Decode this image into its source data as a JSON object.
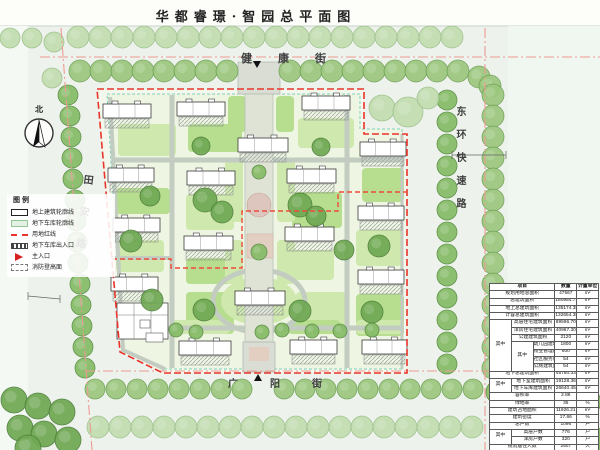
{
  "title": "华都睿璟·智园总平面图",
  "north_label": "北",
  "streets": {
    "top": "健康街",
    "bottom": "广阳街",
    "left": "田安路",
    "right": "东环快速路"
  },
  "legend": {
    "title": "图例",
    "items": [
      {
        "key": "building-outline",
        "label": "地上建筑轮廓线"
      },
      {
        "key": "garage-outline",
        "label": "地下车库轮廓线"
      },
      {
        "key": "red-line",
        "label": "用地红线"
      },
      {
        "key": "garage-entrance",
        "label": "地下车库出入口"
      },
      {
        "key": "main-entrance",
        "label": "主入口"
      },
      {
        "key": "fire-surface",
        "label": "消防登高面"
      }
    ]
  },
  "colors": {
    "boundary_red": "#e8342a",
    "road_centerline": "#ee9a94",
    "garage_line": "#7fd0bd",
    "tree_green": "#85bb66",
    "lawn_green": "#b7dd8e"
  },
  "table": {
    "header": [
      {
        "t": "项目",
        "cs": 3
      },
      {
        "t": "数量"
      },
      {
        "t": "计量单位"
      }
    ],
    "rows": [
      [
        {
          "t": "规划用地总面积",
          "cs": 3
        },
        {
          "t": "47567"
        },
        {
          "t": "m²"
        }
      ],
      [
        {
          "t": "总建筑面积",
          "cs": 3
        },
        {
          "t": "180954.71"
        },
        {
          "t": "m²"
        }
      ],
      [
        {
          "t": "地上总建筑面积",
          "cs": 3
        },
        {
          "t": "135174.38"
        },
        {
          "t": "m²"
        }
      ],
      [
        {
          "t": "计容总建筑面积",
          "cs": 3
        },
        {
          "t": "132654.38"
        },
        {
          "t": "m²"
        }
      ],
      [
        {
          "t": "其中",
          "rs": 7
        },
        {
          "t": "高层住宅建筑面积",
          "cs": 2
        },
        {
          "t": "89596.70"
        },
        {
          "t": "m²"
        }
      ],
      [
        {
          "t": "洋房住宅建筑面积",
          "cs": 2
        },
        {
          "t": "40967.30"
        },
        {
          "t": "m²"
        }
      ],
      [
        {
          "t": "公建建筑面积",
          "cs": 2
        },
        {
          "t": "2120"
        },
        {
          "t": "m²"
        }
      ],
      [
        {
          "t": "其中",
          "rs": 4
        },
        {
          "t": "幼儿园建筑面积"
        },
        {
          "t": "1800"
        },
        {
          "t": "m²"
        }
      ],
      [
        {
          "t": "物业管理用房面积"
        },
        {
          "t": "600"
        },
        {
          "t": "m²"
        }
      ],
      [
        {
          "t": "社区服务用房面积"
        },
        {
          "t": "54"
        },
        {
          "t": "m²"
        }
      ],
      [
        {
          "t": "公厕建筑面积"
        },
        {
          "t": "54"
        },
        {
          "t": "m²"
        }
      ],
      [
        {
          "t": "地下总建筑面积",
          "cs": 3
        },
        {
          "t": "45780.33"
        },
        {
          "t": "m²"
        }
      ],
      [
        {
          "t": "其中",
          "rs": 2
        },
        {
          "t": "地下室建筑面积",
          "cs": 2
        },
        {
          "t": "19128.36"
        },
        {
          "t": "m²"
        }
      ],
      [
        {
          "t": "地下车库建筑面积",
          "cs": 2
        },
        {
          "t": "26640.45"
        },
        {
          "t": "m²"
        }
      ],
      [
        {
          "t": "容积率",
          "cs": 3
        },
        {
          "t": "2.86"
        },
        {
          "t": ""
        }
      ],
      [
        {
          "t": "绿地率",
          "cs": 3
        },
        {
          "t": "35"
        },
        {
          "t": "%"
        }
      ],
      [
        {
          "t": "建筑占地面积",
          "cs": 3
        },
        {
          "t": "11926.21"
        },
        {
          "t": "m²"
        }
      ],
      [
        {
          "t": "建筑密度",
          "cs": 3
        },
        {
          "t": "17.66"
        },
        {
          "t": "%"
        }
      ],
      [
        {
          "t": "总户数",
          "cs": 3
        },
        {
          "t": "1096"
        },
        {
          "t": "户"
        }
      ],
      [
        {
          "t": "其中",
          "rs": 2
        },
        {
          "t": "高层户数",
          "cs": 2
        },
        {
          "t": "776"
        },
        {
          "t": "户"
        }
      ],
      [
        {
          "t": "洋房户数",
          "cs": 2
        },
        {
          "t": "320"
        },
        {
          "t": "户"
        }
      ],
      [
        {
          "t": "规划居住人数",
          "cs": 3
        },
        {
          "t": "2507"
        },
        {
          "t": "人"
        }
      ],
      [
        {
          "t": "机动车停车位",
          "cs": 3
        },
        {
          "t": "1352"
        },
        {
          "t": "个"
        }
      ],
      [
        {
          "t": "非机动车停车位",
          "cs": 3
        },
        {
          "t": "2366"
        },
        {
          "t": "辆"
        }
      ]
    ]
  },
  "map": {
    "buildings": [
      [
        103,
        104,
        48
      ],
      [
        177,
        102,
        48
      ],
      [
        302,
        96,
        48
      ],
      [
        238,
        138,
        50
      ],
      [
        108,
        168,
        46
      ],
      [
        187,
        171,
        48
      ],
      [
        287,
        169,
        49
      ],
      [
        360,
        142,
        46
      ],
      [
        358,
        206,
        46
      ],
      [
        358,
        270,
        46
      ],
      [
        113,
        218,
        47
      ],
      [
        111,
        277,
        47
      ],
      [
        184,
        236,
        49
      ],
      [
        285,
        227,
        49
      ],
      [
        235,
        291,
        50
      ],
      [
        179,
        341,
        52
      ],
      [
        290,
        340,
        47
      ],
      [
        362,
        340,
        45
      ]
    ],
    "kindergarten": [
      117,
      303,
      51,
      36
    ],
    "trees": [
      [
        78,
        37,
        11,
        "c"
      ],
      [
        100,
        37,
        11,
        "c"
      ],
      [
        122,
        37,
        11,
        "c"
      ],
      [
        144,
        37,
        11,
        "c"
      ],
      [
        166,
        37,
        11,
        "c"
      ],
      [
        188,
        37,
        11,
        "c"
      ],
      [
        210,
        37,
        11,
        "c"
      ],
      [
        232,
        37,
        11,
        "c"
      ],
      [
        254,
        37,
        11,
        "c"
      ],
      [
        276,
        37,
        11,
        "c"
      ],
      [
        298,
        37,
        11,
        "c"
      ],
      [
        320,
        37,
        11,
        "c"
      ],
      [
        342,
        37,
        11,
        "c"
      ],
      [
        364,
        37,
        11,
        "c"
      ],
      [
        386,
        37,
        11,
        "c"
      ],
      [
        408,
        37,
        11,
        "c"
      ],
      [
        430,
        37,
        11,
        "c"
      ],
      [
        452,
        37,
        11,
        "c"
      ],
      [
        80,
        71,
        11,
        "a"
      ],
      [
        101,
        71,
        11,
        "a"
      ],
      [
        122,
        71,
        11,
        "a"
      ],
      [
        143,
        71,
        11,
        "a"
      ],
      [
        164,
        71,
        11,
        "a"
      ],
      [
        185,
        71,
        11,
        "a"
      ],
      [
        206,
        71,
        11,
        "a"
      ],
      [
        227,
        71,
        11,
        "a"
      ],
      [
        290,
        71,
        11,
        "a"
      ],
      [
        311,
        71,
        11,
        "a"
      ],
      [
        332,
        71,
        11,
        "a"
      ],
      [
        353,
        71,
        11,
        "a"
      ],
      [
        374,
        71,
        11,
        "a"
      ],
      [
        395,
        71,
        11,
        "a"
      ],
      [
        416,
        71,
        11,
        "a"
      ],
      [
        437,
        71,
        11,
        "a"
      ],
      [
        458,
        71,
        11,
        "a"
      ],
      [
        479,
        77,
        11,
        "a"
      ],
      [
        490,
        86,
        11,
        "a"
      ],
      [
        493,
        95,
        11,
        "a"
      ],
      [
        493,
        116,
        11,
        "a"
      ],
      [
        493,
        137,
        11,
        "a"
      ],
      [
        493,
        158,
        11,
        "a"
      ],
      [
        493,
        179,
        11,
        "a"
      ],
      [
        493,
        200,
        11,
        "a"
      ],
      [
        493,
        221,
        11,
        "a"
      ],
      [
        493,
        242,
        11,
        "a"
      ],
      [
        493,
        263,
        11,
        "a"
      ],
      [
        493,
        284,
        11,
        "a"
      ],
      [
        493,
        305,
        11,
        "a"
      ],
      [
        493,
        326,
        11,
        "a"
      ],
      [
        493,
        347,
        11,
        "a"
      ],
      [
        493,
        368,
        11,
        "a"
      ],
      [
        447,
        100,
        10,
        "b"
      ],
      [
        447,
        122,
        10,
        "b"
      ],
      [
        447,
        144,
        10,
        "b"
      ],
      [
        447,
        166,
        10,
        "b"
      ],
      [
        447,
        188,
        10,
        "b"
      ],
      [
        447,
        210,
        10,
        "b"
      ],
      [
        447,
        232,
        10,
        "b"
      ],
      [
        447,
        254,
        10,
        "b"
      ],
      [
        447,
        276,
        10,
        "b"
      ],
      [
        447,
        298,
        10,
        "b"
      ],
      [
        447,
        320,
        10,
        "b"
      ],
      [
        447,
        342,
        10,
        "b"
      ],
      [
        447,
        364,
        10,
        "b"
      ],
      [
        95,
        389,
        10,
        "a"
      ],
      [
        116,
        389,
        10,
        "a"
      ],
      [
        137,
        389,
        10,
        "a"
      ],
      [
        158,
        389,
        10,
        "a"
      ],
      [
        179,
        389,
        10,
        "a"
      ],
      [
        200,
        389,
        10,
        "a"
      ],
      [
        221,
        389,
        10,
        "a"
      ],
      [
        242,
        389,
        10,
        "a"
      ],
      [
        284,
        389,
        10,
        "a"
      ],
      [
        305,
        389,
        10,
        "a"
      ],
      [
        326,
        389,
        10,
        "a"
      ],
      [
        347,
        389,
        10,
        "a"
      ],
      [
        368,
        389,
        10,
        "a"
      ],
      [
        389,
        389,
        10,
        "a"
      ],
      [
        410,
        389,
        10,
        "a"
      ],
      [
        431,
        389,
        10,
        "a"
      ],
      [
        452,
        389,
        10,
        "a"
      ],
      [
        473,
        389,
        10,
        "a"
      ],
      [
        98,
        427,
        11,
        "c"
      ],
      [
        120,
        427,
        11,
        "c"
      ],
      [
        142,
        427,
        11,
        "c"
      ],
      [
        164,
        427,
        11,
        "c"
      ],
      [
        186,
        427,
        11,
        "c"
      ],
      [
        208,
        427,
        11,
        "c"
      ],
      [
        230,
        427,
        11,
        "c"
      ],
      [
        252,
        427,
        11,
        "c"
      ],
      [
        274,
        427,
        11,
        "c"
      ],
      [
        296,
        427,
        11,
        "c"
      ],
      [
        318,
        427,
        11,
        "c"
      ],
      [
        340,
        427,
        11,
        "c"
      ],
      [
        362,
        427,
        11,
        "c"
      ],
      [
        384,
        427,
        11,
        "c"
      ],
      [
        406,
        427,
        11,
        "c"
      ],
      [
        428,
        427,
        11,
        "c"
      ],
      [
        450,
        427,
        11,
        "c"
      ],
      [
        472,
        427,
        11,
        "c"
      ],
      [
        14,
        400,
        13,
        "d"
      ],
      [
        38,
        406,
        13,
        "d"
      ],
      [
        62,
        412,
        13,
        "d"
      ],
      [
        20,
        428,
        13,
        "d"
      ],
      [
        44,
        434,
        13,
        "d"
      ],
      [
        68,
        440,
        13,
        "d"
      ],
      [
        28,
        448,
        13,
        "d"
      ],
      [
        498,
        392,
        12,
        "b"
      ],
      [
        520,
        390,
        12,
        "b"
      ],
      [
        543,
        394,
        12,
        "b"
      ],
      [
        566,
        398,
        12,
        "b"
      ],
      [
        589,
        402,
        12,
        "b"
      ],
      [
        505,
        414,
        12,
        "b"
      ],
      [
        529,
        418,
        12,
        "b"
      ],
      [
        553,
        422,
        12,
        "b"
      ],
      [
        577,
        426,
        12,
        "b"
      ],
      [
        596,
        440,
        12,
        "b"
      ],
      [
        68,
        95,
        10,
        "b"
      ],
      [
        70,
        116,
        10,
        "b"
      ],
      [
        71,
        137,
        10,
        "b"
      ],
      [
        72,
        158,
        10,
        "b"
      ],
      [
        73,
        179,
        10,
        "b"
      ],
      [
        75,
        200,
        10,
        "b"
      ],
      [
        76,
        221,
        10,
        "b"
      ],
      [
        77,
        242,
        10,
        "b"
      ],
      [
        78,
        263,
        10,
        "b"
      ],
      [
        80,
        284,
        10,
        "b"
      ],
      [
        81,
        305,
        10,
        "b"
      ],
      [
        82,
        326,
        10,
        "b"
      ],
      [
        83,
        347,
        10,
        "b"
      ],
      [
        85,
        368,
        10,
        "b"
      ],
      [
        10,
        38,
        10,
        "c"
      ],
      [
        32,
        38,
        10,
        "c"
      ],
      [
        54,
        42,
        10,
        "c"
      ],
      [
        52,
        78,
        10,
        "c"
      ],
      [
        382,
        108,
        13,
        "c"
      ],
      [
        408,
        112,
        15,
        "c"
      ],
      [
        428,
        98,
        11,
        "c"
      ],
      [
        205,
        200,
        12,
        "d"
      ],
      [
        222,
        212,
        11,
        "d"
      ],
      [
        300,
        205,
        12,
        "d"
      ],
      [
        316,
        216,
        10,
        "d"
      ],
      [
        204,
        310,
        11,
        "d"
      ],
      [
        300,
        311,
        11,
        "d"
      ],
      [
        150,
        196,
        10,
        "d"
      ],
      [
        344,
        250,
        10,
        "d"
      ],
      [
        131,
        241,
        11,
        "d"
      ],
      [
        379,
        246,
        11,
        "d"
      ],
      [
        152,
        300,
        11,
        "d"
      ],
      [
        372,
        312,
        11,
        "d"
      ],
      [
        201,
        146,
        9,
        "d"
      ],
      [
        321,
        147,
        9,
        "d"
      ],
      [
        176,
        330,
        7,
        "b"
      ],
      [
        196,
        332,
        7,
        "b"
      ],
      [
        262,
        332,
        7,
        "b"
      ],
      [
        282,
        330,
        7,
        "b"
      ],
      [
        312,
        331,
        7,
        "b"
      ],
      [
        340,
        331,
        7,
        "b"
      ],
      [
        372,
        330,
        7,
        "b"
      ],
      [
        259,
        172,
        7,
        "b"
      ],
      [
        259,
        252,
        8,
        "b"
      ]
    ],
    "lawns": [
      [
        118,
        124,
        58,
        32,
        "g2"
      ],
      [
        188,
        124,
        54,
        28,
        "g1"
      ],
      [
        298,
        118,
        56,
        30,
        "g2"
      ],
      [
        362,
        168,
        42,
        34,
        "g1"
      ],
      [
        116,
        188,
        54,
        26,
        "g1"
      ],
      [
        186,
        194,
        48,
        36,
        "g2"
      ],
      [
        292,
        192,
        50,
        36,
        "g1"
      ],
      [
        116,
        240,
        48,
        32,
        "g2"
      ],
      [
        186,
        258,
        46,
        26,
        "g1"
      ],
      [
        284,
        250,
        50,
        30,
        "g2"
      ],
      [
        356,
        230,
        46,
        36,
        "g2"
      ],
      [
        186,
        292,
        48,
        42,
        "g1"
      ],
      [
        296,
        292,
        50,
        38,
        "g2"
      ],
      [
        356,
        294,
        48,
        42,
        "g1"
      ],
      [
        172,
        320,
        58,
        14,
        "g2"
      ],
      [
        288,
        320,
        52,
        14,
        "g1"
      ],
      [
        356,
        320,
        48,
        14,
        "g2"
      ],
      [
        228,
        96,
        18,
        36,
        "g1"
      ],
      [
        276,
        96,
        18,
        36,
        "g1"
      ],
      [
        225,
        158,
        18,
        64,
        "g2"
      ],
      [
        277,
        158,
        18,
        64,
        "g2"
      ],
      [
        225,
        240,
        18,
        44,
        "g2"
      ],
      [
        277,
        240,
        18,
        44,
        "g2"
      ]
    ]
  }
}
